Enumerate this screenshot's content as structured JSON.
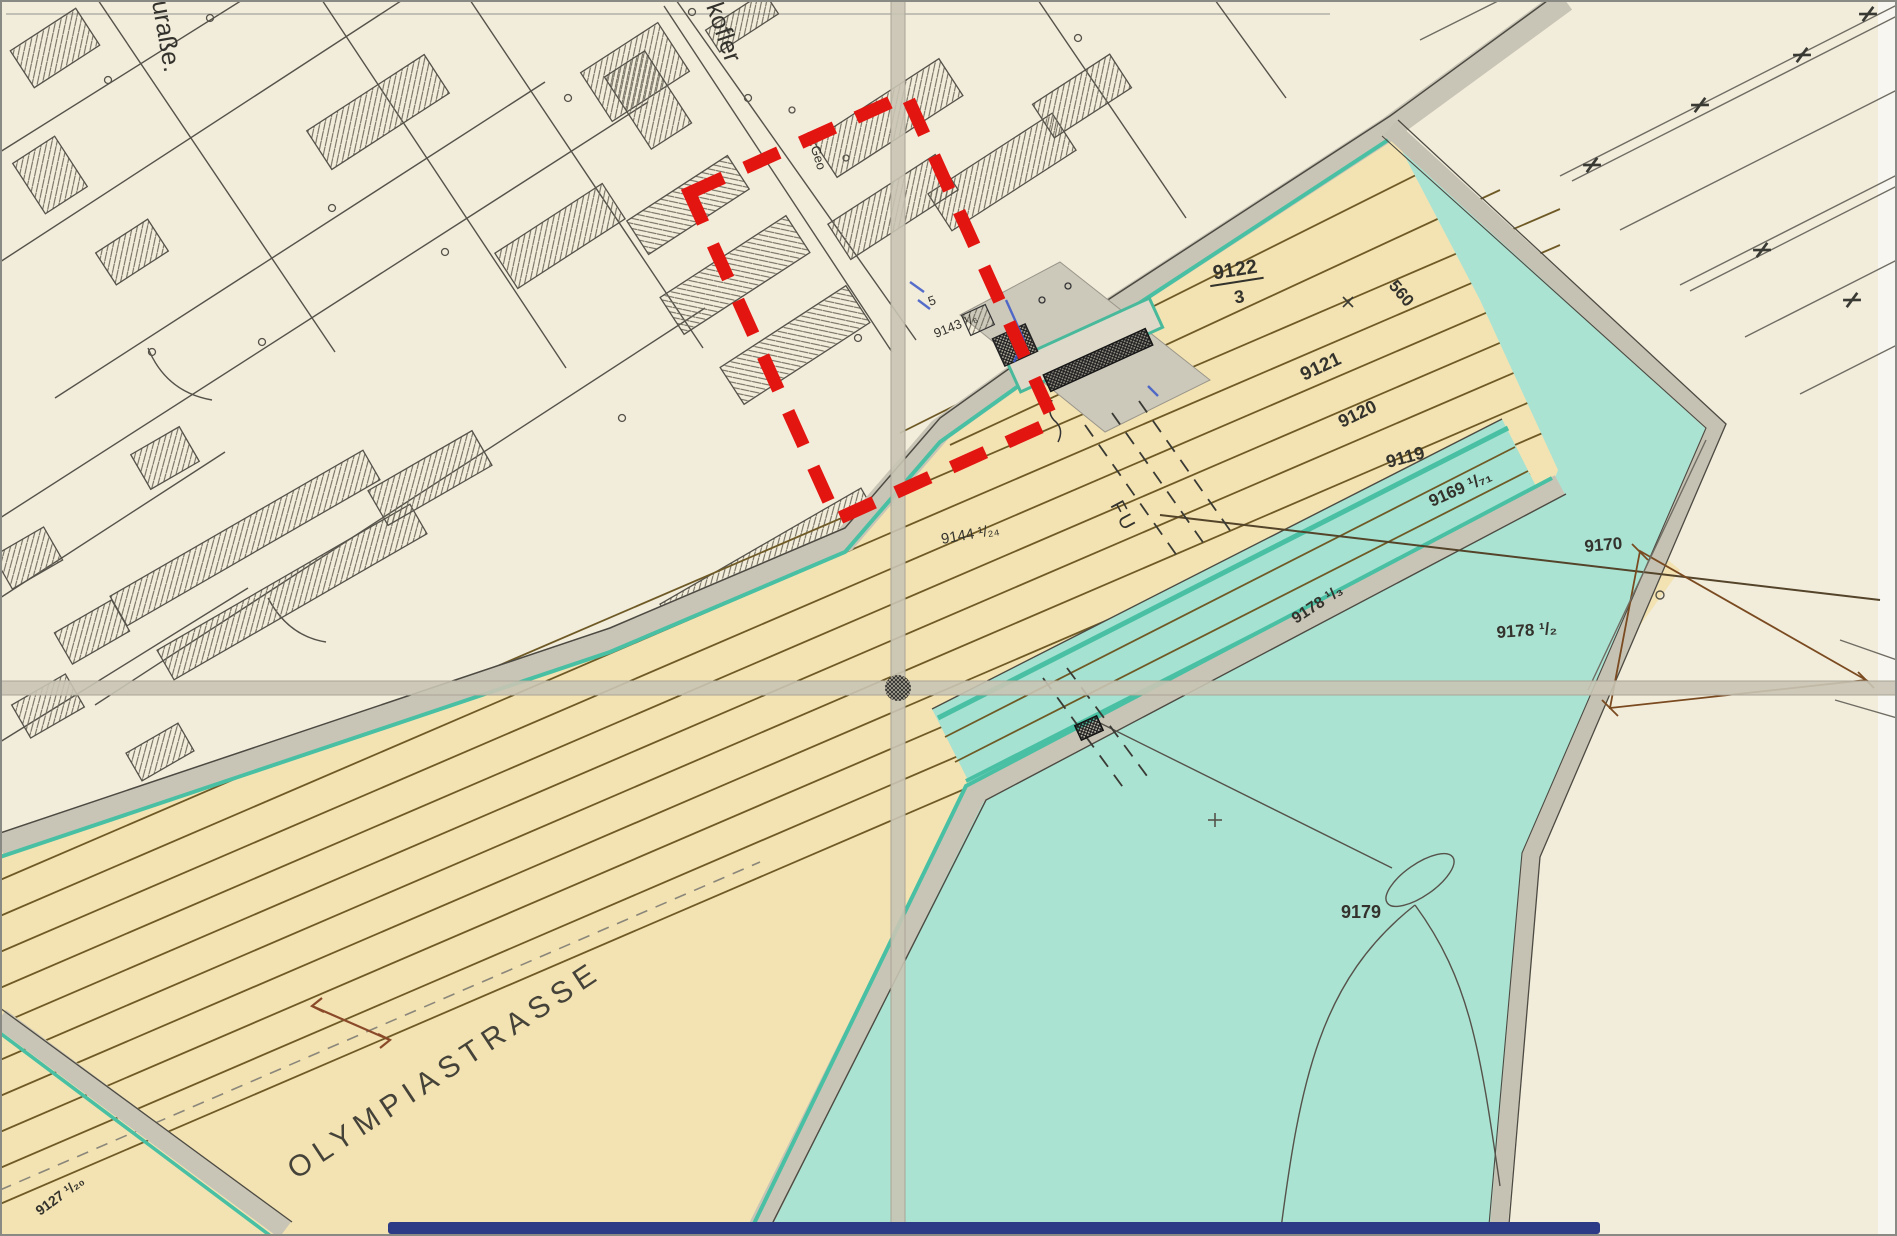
{
  "map": {
    "kind": "scanned cadastral plan with red highlight annotation",
    "labels": {
      "street_fragment": "uraße.",
      "street_kofler": "kofler",
      "street_stgeo": "St.Geo",
      "parcel_9122_num": "9122",
      "parcel_9122_den": "3",
      "track_560": "560",
      "parcel_9121": "9121",
      "parcel_9120": "9120",
      "parcel_9119": "9119",
      "parcel_9169": "9169 ¹/₇₁",
      "parcel_9170": "9170",
      "parcel_9178_13": "9178 ¹/₃",
      "parcel_9178_12": "9178 ¹/₂",
      "parcel_9179": "9179",
      "parcel_9144": "9144 ¹/₂₄",
      "parcel_9143": "9143 ¹/₆",
      "mark_5": "5",
      "underpass": "FU",
      "street_olympia": "OLYMPIASTRASSE",
      "parcel_9127": "9127 ¹/₂₀"
    },
    "colors": {
      "paper": "#f2ecda",
      "band_yellow": "#f3e3b2",
      "teal_area": "#abe3d3",
      "teal_line": "#49c0a3",
      "gray_strip": "#c9c5b6",
      "track_brown": "#6f5a26",
      "line_dark": "#4c4a42",
      "highlight_red": "#e21511",
      "ink_blue": "#3a57c8",
      "scan_edge_blue": "#2d3a86"
    }
  }
}
